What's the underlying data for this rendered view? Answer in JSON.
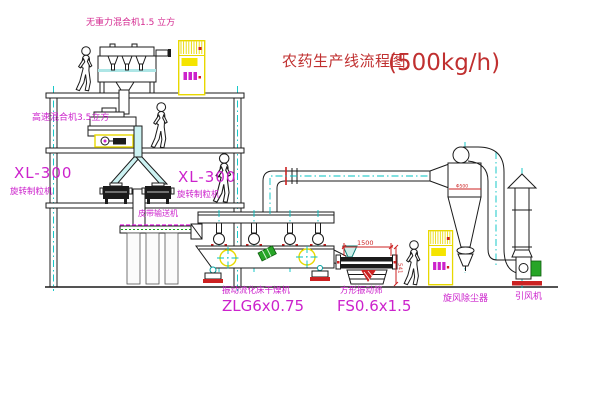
{
  "title": {
    "main": "农药生产线流程图",
    "capacity": "(500kg/h)"
  },
  "equipment_labels": {
    "gravity_mixer": "无重力混合机1.5 立方",
    "high_speed_mixer": "高速混合机3.5立方",
    "granulator_left_model": "XL-300",
    "granulator_left_name": "旋转制粒机",
    "granulator_right_model": "XL-300",
    "granulator_right_name": "旋转制粒机",
    "belt_conveyor": "皮带输送机",
    "fluid_bed_dryer_name": "振动流化床干燥机",
    "fluid_bed_dryer_model": "ZLG6x0.75",
    "vibrating_screen_name": "方形振动筛",
    "vibrating_screen_model": "FS0.6x1.5",
    "cyclone_dust_collector": "旋风除尘器",
    "induced_draft_fan": "引风机"
  },
  "dimension_annotations": {
    "screen_length": "1500",
    "screen_height": "541",
    "cyclone_note": "Φ500"
  },
  "colors": {
    "outline": "#1b1b1b",
    "centerline_cyan": "#00c2c2",
    "label_magenta": "#cc22cc",
    "title_red": "#c03030",
    "dimension_red": "#cc2222",
    "cabinet_yellow": "#f0df00",
    "motor_green": "#27a527",
    "pipe_fill_cyan": "#ccf2f2"
  }
}
